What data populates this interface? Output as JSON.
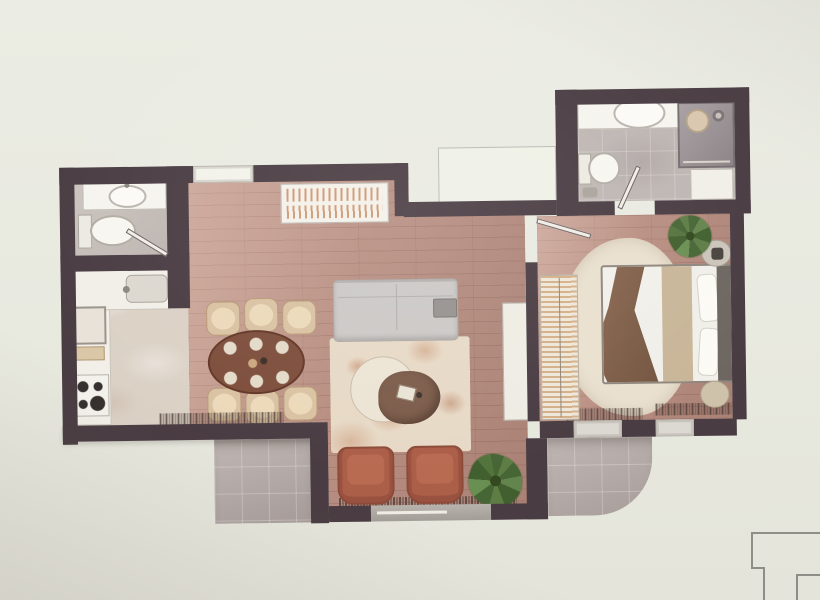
{
  "meta": {
    "type": "photographed-apartment-floor-plan",
    "text_visible": false
  },
  "palette": {
    "background": "#e9eae1",
    "wall": "#493c42",
    "wood_floor": "#b98f82",
    "tile_terrace": "#b5aaa7",
    "bath_tile": "#beb6b3",
    "kitchen_floor": "#dbd1c5",
    "counter_white": "#f2efe8",
    "sofa_gray": "#cbc8c6",
    "rug_cream": "#e7d9c6",
    "rug_bedroom": "#e9e0cf",
    "armchair_terracotta": "#ab5e48",
    "dining_table_brown": "#7d4d3b",
    "chair_beige": "#d9c2a2",
    "coffee_table_brown": "#7c5c4a",
    "coffee_table_cream": "#ece4d4",
    "bed_white": "#f1efe9",
    "headboard_gray": "#6e6761",
    "throw_brown": "#6f523e",
    "runner_tan": "#c9b699",
    "plant_green": "#5d7d45",
    "window_light": "#eff1e7",
    "keyplan_line": "#8e8e88"
  },
  "scene": {
    "rooms": [
      "bathroom-small-top-left",
      "kitchen",
      "living-dining-room",
      "bedroom",
      "bathroom-main-top-right",
      "entry-terrace",
      "bedroom-terrace"
    ],
    "furniture": [
      "washbasin-x2",
      "toilet-x2",
      "shower",
      "kitchen-counter-l-shape",
      "cooktop-4-burners",
      "oven",
      "kitchen-sink",
      "dining-table-oval",
      "dining-chairs-6",
      "sideboard",
      "sofa",
      "coffee-tables-2",
      "area-rug",
      "armchairs-2",
      "potted-plants-2",
      "tv-cabinet",
      "open-wardrobe",
      "double-bed",
      "nightstand",
      "pouf",
      "bathroom-cabinet",
      "doors-3",
      "sliding-glass-door",
      "windows-4"
    ],
    "keyplan": "partial-outline-bottom-right-corner"
  }
}
